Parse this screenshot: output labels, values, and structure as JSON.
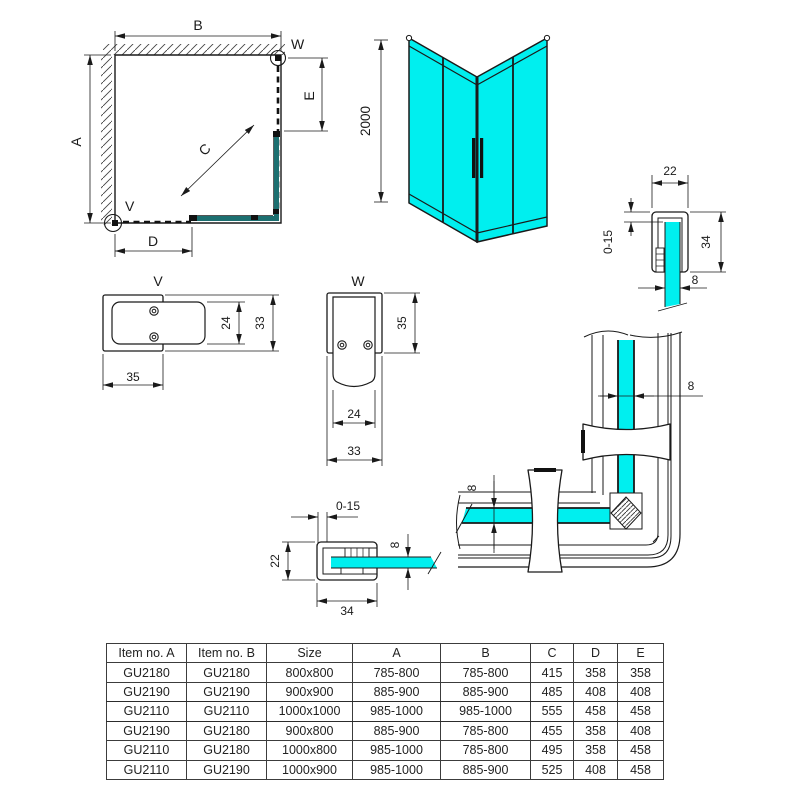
{
  "colors": {
    "glass": "#00efef",
    "plan_glass": "#1c6f70",
    "line": "#1a1a1a"
  },
  "plan_view": {
    "dim_a": "A",
    "dim_b": "B",
    "dim_c": "C",
    "dim_d": "D",
    "dim_e": "E",
    "detail_v_ref": "V",
    "detail_w_ref": "W"
  },
  "front_view": {
    "height": "2000"
  },
  "wall_profile_top": {
    "width": "22",
    "adjust_range": "0-15",
    "depth": "34",
    "glass_thickness": "8"
  },
  "detail_v": {
    "label": "V",
    "width": "35",
    "arm_height": "24",
    "body_height": "33"
  },
  "detail_w": {
    "label": "W",
    "body_height": "35",
    "arm_width": "24",
    "body_width": "33"
  },
  "wall_profile_bottom": {
    "adjust_range": "0-15",
    "depth": "22",
    "glass_thickness": "8",
    "width": "34"
  },
  "corner_detail": {
    "glass_thickness_vertical": "8",
    "glass_thickness_horizontal": "8"
  },
  "spec_table": {
    "headers": [
      "Item no. A",
      "Item no. B",
      "Size",
      "A",
      "B",
      "C",
      "D",
      "E"
    ],
    "rows": [
      [
        "GU2180",
        "GU2180",
        "800x800",
        "785-800",
        "785-800",
        "415",
        "358",
        "358"
      ],
      [
        "GU2190",
        "GU2190",
        "900x900",
        "885-900",
        "885-900",
        "485",
        "408",
        "408"
      ],
      [
        "GU2110",
        "GU2110",
        "1000x1000",
        "985-1000",
        "985-1000",
        "555",
        "458",
        "458"
      ],
      [
        "GU2190",
        "GU2180",
        "900x800",
        "885-900",
        "785-800",
        "455",
        "358",
        "408"
      ],
      [
        "GU2110",
        "GU2180",
        "1000x800",
        "985-1000",
        "785-800",
        "495",
        "358",
        "458"
      ],
      [
        "GU2110",
        "GU2190",
        "1000x900",
        "985-1000",
        "885-900",
        "525",
        "408",
        "458"
      ]
    ]
  }
}
